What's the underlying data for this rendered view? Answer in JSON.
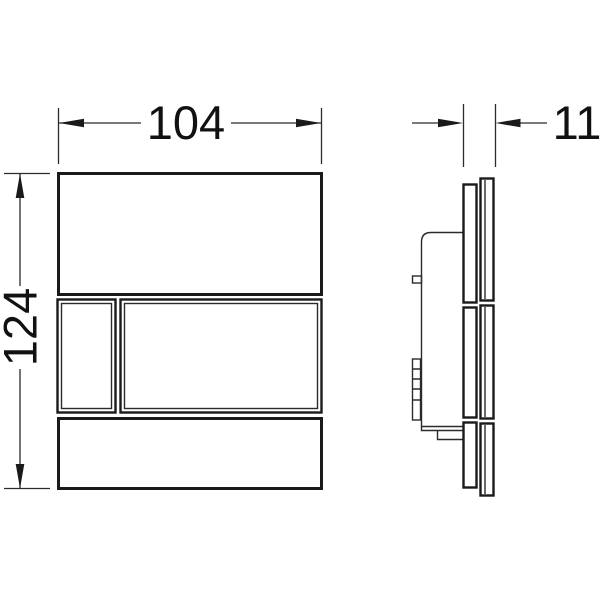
{
  "drawing": {
    "kind": "flush-plate-technical-drawing",
    "colors": {
      "line": "#1a1a1a",
      "dimension_line": "#2b2b2b",
      "text": "#111111",
      "background": "#ffffff"
    },
    "dimensions": {
      "width": "104",
      "height": "124",
      "depth": "11"
    }
  }
}
